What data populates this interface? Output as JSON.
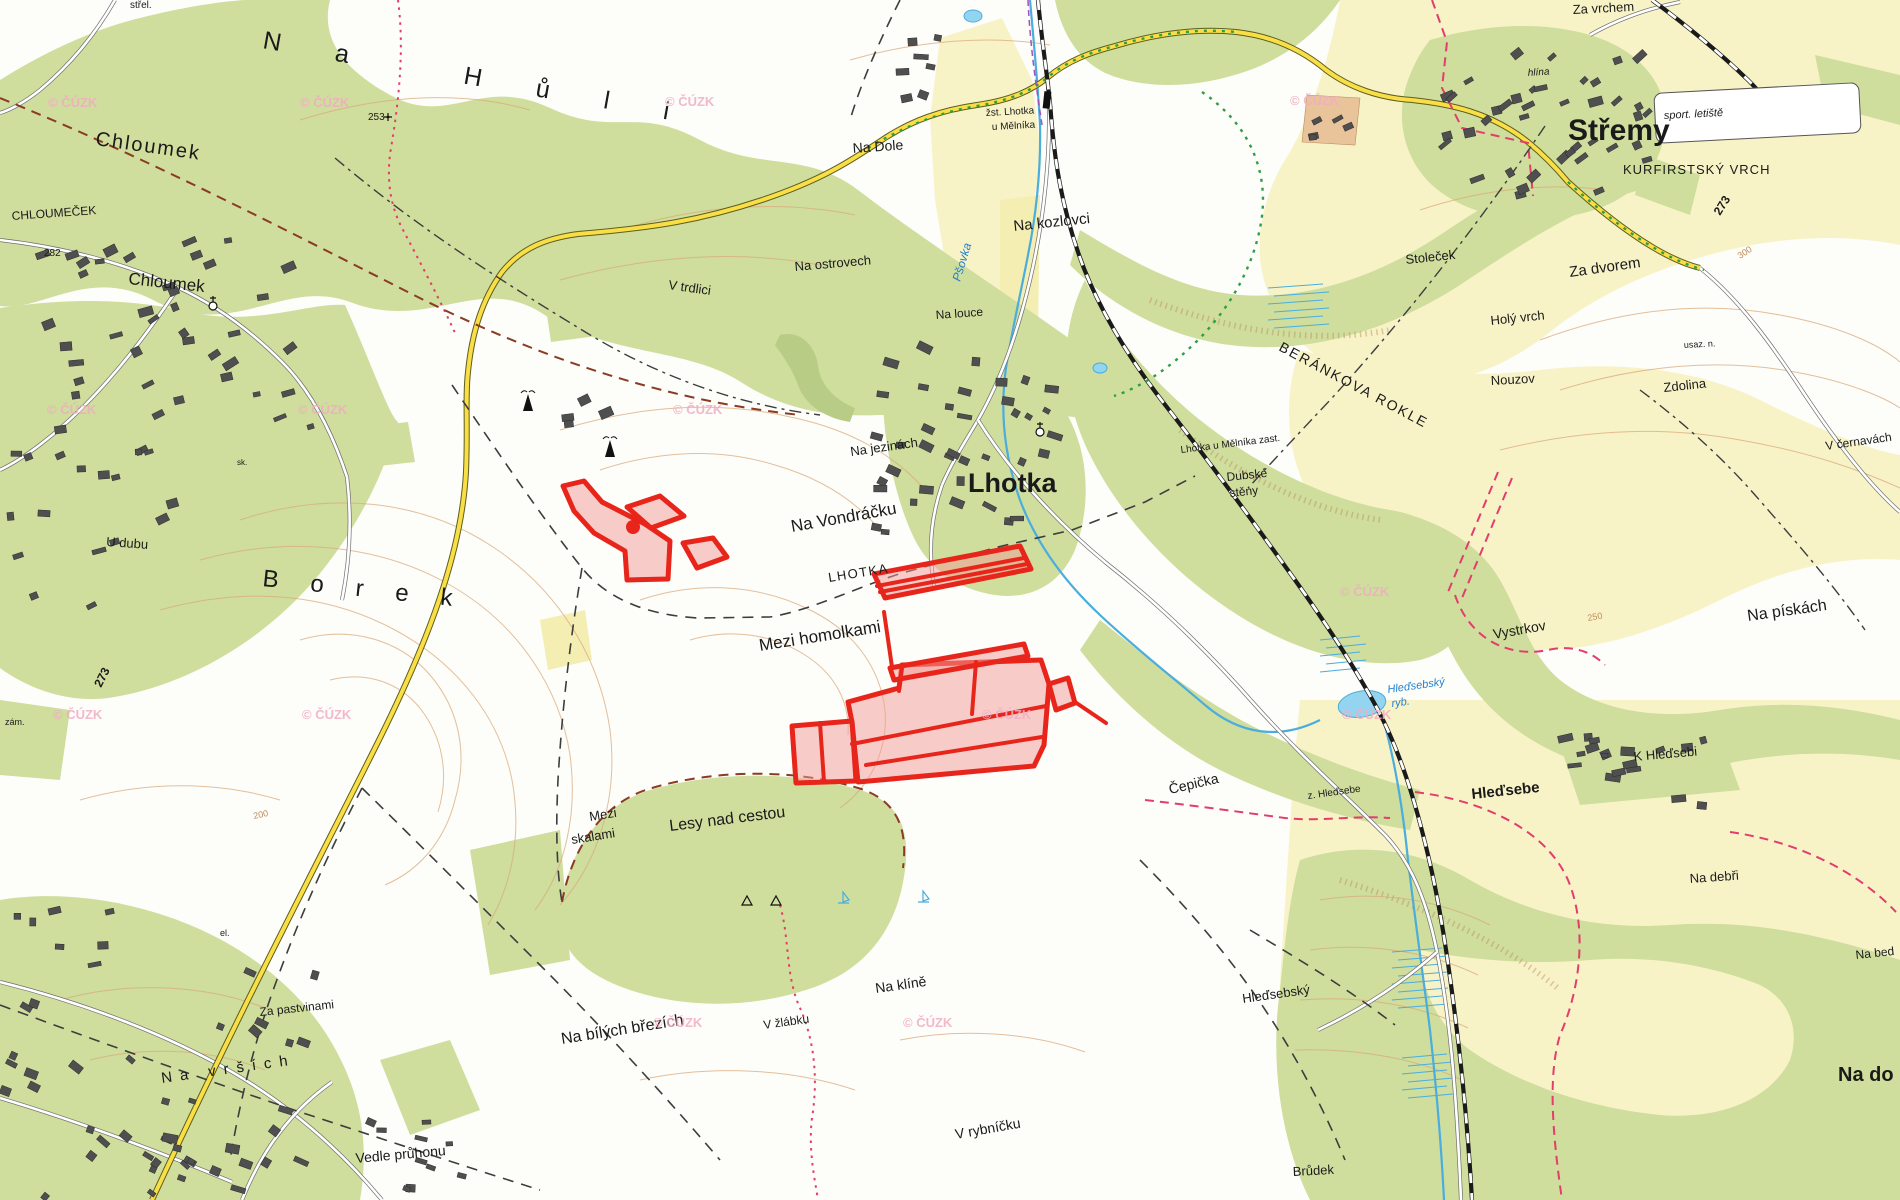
{
  "map": {
    "attribution": "© ČÚZK",
    "colors": {
      "forest": "#cfdd9d",
      "forest_dark": "#b9cc85",
      "field_yellow": "#f8f3c7",
      "orange_area": "#e9c49a",
      "water": "#4aadde",
      "water_fill": "#93d5f0",
      "contour": "#d9a97b",
      "road_yellow": "#f9df45",
      "railway": "#1a1a1a",
      "boundary_red": "#e23d6d",
      "boundary_darkred": "#8a3b24",
      "dash_black": "#3d3d3d",
      "trail_green": "#2f9e44",
      "parcel_stroke": "#e8251b",
      "parcel_fill": "#f29b95",
      "label": "#1a1a1a",
      "water_label": "#1f7fd0",
      "watermark": "#f0aec2",
      "building": "#4f4f4f"
    },
    "labels": [
      {
        "id": "strel",
        "t": "střel.",
        "x": 130,
        "y": 8,
        "s": 10,
        "r": 0
      },
      {
        "id": "na-huli",
        "t": "Na Hůli",
        "x": 262,
        "y": 48,
        "s": 25,
        "r": 10,
        "ls": 55
      },
      {
        "id": "chloumek-forest",
        "t": "Chloumek",
        "x": 95,
        "y": 145,
        "s": 20,
        "r": 8,
        "ls": 2
      },
      {
        "id": "chloumecek",
        "t": "CHLOUMEČEK",
        "x": 12,
        "y": 220,
        "s": 12,
        "r": -4
      },
      {
        "id": "h282",
        "t": "282",
        "x": 44,
        "y": 256,
        "s": 10,
        "r": 0
      },
      {
        "id": "chloumek-village",
        "t": "Chloumek",
        "x": 128,
        "y": 284,
        "s": 17,
        "r": 6
      },
      {
        "id": "h253",
        "t": "253",
        "x": 368,
        "y": 120,
        "s": 10,
        "r": 0
      },
      {
        "id": "na-dole",
        "t": "Na Dole",
        "x": 853,
        "y": 153,
        "s": 14,
        "r": -4
      },
      {
        "id": "zst-1",
        "t": "žst. Lhotka",
        "x": 986,
        "y": 116,
        "s": 10,
        "r": -3
      },
      {
        "id": "zst-2",
        "t": "u Mělníka",
        "x": 992,
        "y": 130,
        "s": 10,
        "r": -3
      },
      {
        "id": "na-kozlovci",
        "t": "Na kozlovci",
        "x": 1014,
        "y": 231,
        "s": 15,
        "r": -6
      },
      {
        "id": "na-ostrovech",
        "t": "Na ostrovech",
        "x": 795,
        "y": 271,
        "s": 13,
        "r": -5
      },
      {
        "id": "v-trdlici",
        "t": "V trdlici",
        "x": 668,
        "y": 289,
        "s": 13,
        "r": 8
      },
      {
        "id": "na-louce",
        "t": "Na louce",
        "x": 936,
        "y": 319,
        "s": 12,
        "r": -4
      },
      {
        "id": "psovka",
        "t": "Pšovka",
        "x": 960,
        "y": 282,
        "s": 12,
        "r": -73,
        "c": "water"
      },
      {
        "id": "stremy",
        "t": "Střemy",
        "x": 1568,
        "y": 140,
        "s": 30,
        "w": "bold"
      },
      {
        "id": "sport-letiste",
        "t": "sport. letiště",
        "x": 1664,
        "y": 119,
        "s": 11,
        "r": -3,
        "i": true
      },
      {
        "id": "kurfirstsky-vrch",
        "t": "KURFIRSTSKÝ VRCH",
        "x": 1623,
        "y": 174,
        "s": 13,
        "ls": 1
      },
      {
        "id": "r273-ne",
        "t": "273",
        "x": 1720,
        "y": 216,
        "s": 12,
        "r": -58,
        "w": "bold"
      },
      {
        "id": "c300",
        "t": "300",
        "x": 1740,
        "y": 259,
        "s": 9,
        "r": -33,
        "c": "contour"
      },
      {
        "id": "za-vrchem",
        "t": "Za vrchem",
        "x": 1573,
        "y": 14,
        "s": 13,
        "r": -3
      },
      {
        "id": "hlina",
        "t": "hlína",
        "x": 1528,
        "y": 76,
        "s": 10,
        "r": -4,
        "i": true
      },
      {
        "id": "stolecek",
        "t": "Stoleček",
        "x": 1406,
        "y": 264,
        "s": 13,
        "r": -6
      },
      {
        "id": "za-dvorem",
        "t": "Za dvorem",
        "x": 1570,
        "y": 277,
        "s": 15,
        "r": -8
      },
      {
        "id": "holy-vrch",
        "t": "Holý vrch",
        "x": 1491,
        "y": 325,
        "s": 13,
        "r": -6
      },
      {
        "id": "nouzov",
        "t": "Nouzov",
        "x": 1491,
        "y": 385,
        "s": 13,
        "r": -3
      },
      {
        "id": "zdolina",
        "t": "Zdolina",
        "x": 1664,
        "y": 392,
        "s": 13,
        "r": -6
      },
      {
        "id": "usaz-n",
        "t": "usaz. n.",
        "x": 1684,
        "y": 348,
        "s": 9,
        "r": -3
      },
      {
        "id": "v-cernavach",
        "t": "V černavách",
        "x": 1826,
        "y": 450,
        "s": 12,
        "r": -8
      },
      {
        "id": "berankova-rokle",
        "t": "BERÁNKOVA ROKLE",
        "x": 1278,
        "y": 350,
        "s": 14,
        "r": 28,
        "ls": 2
      },
      {
        "id": "lhotka-zast",
        "t": "Lhotka u Mělníka zast.",
        "x": 1181,
        "y": 453,
        "s": 10,
        "r": -7
      },
      {
        "id": "dubske",
        "t": "Dubské",
        "x": 1227,
        "y": 481,
        "s": 12,
        "r": -6
      },
      {
        "id": "steny",
        "t": "stěny",
        "x": 1230,
        "y": 497,
        "s": 12,
        "r": -6
      },
      {
        "id": "lhotka-big",
        "t": "Lhotka",
        "x": 968,
        "y": 492,
        "s": 27,
        "w": "bold"
      },
      {
        "id": "na-jezinach",
        "t": "Na jezinách",
        "x": 851,
        "y": 456,
        "s": 13,
        "r": -8
      },
      {
        "id": "na-vondracku",
        "t": "Na Vondráčku",
        "x": 792,
        "y": 532,
        "s": 17,
        "r": -10
      },
      {
        "id": "lhotka-caps",
        "t": "LHOTKA",
        "x": 829,
        "y": 582,
        "s": 13,
        "r": -9,
        "ls": 1.5
      },
      {
        "id": "mezi-homolkami",
        "t": "Mezi homolkami",
        "x": 760,
        "y": 651,
        "s": 17,
        "r": -9
      },
      {
        "id": "u-dubu",
        "t": "U dubu",
        "x": 106,
        "y": 546,
        "s": 13,
        "r": 4
      },
      {
        "id": "borek",
        "t": "Borek",
        "x": 262,
        "y": 586,
        "s": 24,
        "r": 6,
        "ls": 32
      },
      {
        "id": "r273-left",
        "t": "273",
        "x": 101,
        "y": 688,
        "s": 12,
        "r": -63,
        "w": "bold"
      },
      {
        "id": "zam",
        "t": "zám.",
        "x": 5,
        "y": 725,
        "s": 9
      },
      {
        "id": "sk",
        "t": "sk.",
        "x": 237,
        "y": 465,
        "s": 8
      },
      {
        "id": "el",
        "t": "el.",
        "x": 220,
        "y": 936,
        "s": 9
      },
      {
        "id": "c200",
        "t": "200",
        "x": 254,
        "y": 819,
        "s": 9,
        "r": -12,
        "c": "contour"
      },
      {
        "id": "c250",
        "t": "250",
        "x": 1588,
        "y": 621,
        "s": 9,
        "r": -10,
        "c": "contour"
      },
      {
        "id": "vystrkov",
        "t": "Vystrkov",
        "x": 1494,
        "y": 639,
        "s": 14,
        "r": -10
      },
      {
        "id": "na-piskach",
        "t": "Na pískách",
        "x": 1748,
        "y": 621,
        "s": 16,
        "r": -8
      },
      {
        "id": "hledsebsky-ryb-1",
        "t": "Hleďsebský",
        "x": 1388,
        "y": 693,
        "s": 11,
        "r": -8,
        "c": "water"
      },
      {
        "id": "hledsebsky-ryb-2",
        "t": "ryb.",
        "x": 1392,
        "y": 707,
        "s": 11,
        "r": -8,
        "c": "water"
      },
      {
        "id": "k-hledsebi",
        "t": "K Hleďsebi",
        "x": 1634,
        "y": 761,
        "s": 13,
        "r": -5
      },
      {
        "id": "hledsebe",
        "t": "Hleďsebe",
        "x": 1472,
        "y": 799,
        "s": 15,
        "r": -6,
        "w": "bold"
      },
      {
        "id": "z-hledsebe",
        "t": "z. Hleďsebe",
        "x": 1308,
        "y": 799,
        "s": 10,
        "r": -8
      },
      {
        "id": "cepicka",
        "t": "Čepička",
        "x": 1170,
        "y": 794,
        "s": 14,
        "r": -13
      },
      {
        "id": "na-debri",
        "t": "Na debři",
        "x": 1690,
        "y": 883,
        "s": 13,
        "r": -4
      },
      {
        "id": "na-bed",
        "t": "Na bed",
        "x": 1856,
        "y": 959,
        "s": 12,
        "r": -6
      },
      {
        "id": "lesy-nad-cestou",
        "t": "Lesy nad cestou",
        "x": 670,
        "y": 831,
        "s": 16,
        "r": -7
      },
      {
        "id": "mezi-skalami-1",
        "t": "Mezi",
        "x": 590,
        "y": 821,
        "s": 13,
        "r": -9
      },
      {
        "id": "mezi-skalami-2",
        "t": "skalami",
        "x": 572,
        "y": 844,
        "s": 13,
        "r": -9
      },
      {
        "id": "na-kline",
        "t": "Na klíně",
        "x": 876,
        "y": 993,
        "s": 14,
        "r": -8
      },
      {
        "id": "v-zlabku",
        "t": "V žlábku",
        "x": 764,
        "y": 1029,
        "s": 12,
        "r": -8
      },
      {
        "id": "na-bilych-brezich",
        "t": "Na bílých březích",
        "x": 562,
        "y": 1044,
        "s": 16,
        "r": -9
      },
      {
        "id": "v-rybnicku",
        "t": "V rybníčku",
        "x": 956,
        "y": 1139,
        "s": 14,
        "r": -10
      },
      {
        "id": "hledsebsky-area",
        "t": "Hleďsebský",
        "x": 1243,
        "y": 1003,
        "s": 13,
        "r": -8
      },
      {
        "id": "brudek",
        "t": "Brůdek",
        "x": 1293,
        "y": 1176,
        "s": 13,
        "r": -3
      },
      {
        "id": "na-do",
        "t": "Na do",
        "x": 1838,
        "y": 1081,
        "s": 20,
        "w": "bold"
      },
      {
        "id": "vedle-pruhonu",
        "t": "Vedle průhonu",
        "x": 356,
        "y": 1163,
        "s": 14,
        "r": -5
      },
      {
        "id": "na-vrsich",
        "t": "Na vrších",
        "x": 162,
        "y": 1083,
        "s": 15,
        "r": -8,
        "ls": 8
      },
      {
        "id": "za-pastvinami",
        "t": "Za pastvinami",
        "x": 260,
        "y": 1016,
        "s": 12,
        "r": -6
      }
    ],
    "watermark_positions": [
      [
        48,
        107
      ],
      [
        300,
        107
      ],
      [
        665,
        106
      ],
      [
        1290,
        105
      ],
      [
        47,
        414
      ],
      [
        298,
        414
      ],
      [
        673,
        414
      ],
      [
        1340,
        596
      ],
      [
        53,
        719
      ],
      [
        302,
        719
      ],
      [
        982,
        719
      ],
      [
        653,
        1027
      ],
      [
        903,
        1027
      ],
      [
        1342,
        719
      ]
    ],
    "highlight_parcels": {
      "polygons": [
        {
          "id": "borek-wedge",
          "pts": [
            [
              563,
              486
            ],
            [
              584,
              481
            ],
            [
              602,
              502
            ],
            [
              645,
              524
            ],
            [
              670,
              541
            ],
            [
              668,
              579
            ],
            [
              627,
              580
            ],
            [
              625,
              551
            ],
            [
              594,
              533
            ],
            [
              574,
              511
            ]
          ]
        },
        {
          "id": "borek-para",
          "pts": [
            [
              627,
              507
            ],
            [
              660,
              496
            ],
            [
              684,
              516
            ],
            [
              651,
              528
            ]
          ]
        },
        {
          "id": "borek-rhomb",
          "pts": [
            [
              683,
              543
            ],
            [
              713,
              538
            ],
            [
              727,
              557
            ],
            [
              697,
              568
            ]
          ]
        },
        {
          "id": "band-upper",
          "pts": [
            [
              874,
              574
            ],
            [
              1020,
              546
            ],
            [
              1031,
              569
            ],
            [
              885,
              598
            ]
          ]
        },
        {
          "id": "c-left-para",
          "pts": [
            [
              792,
              726
            ],
            [
              852,
              721
            ],
            [
              856,
              781
            ],
            [
              796,
              783
            ]
          ]
        },
        {
          "id": "c-main",
          "pts": [
            [
              848,
              702
            ],
            [
              899,
              688
            ],
            [
              902,
              665
            ],
            [
              1041,
              660
            ],
            [
              1049,
              684
            ],
            [
              1044,
              745
            ],
            [
              1034,
              766
            ],
            [
              858,
              782
            ],
            [
              852,
              722
            ]
          ]
        },
        {
          "id": "c-top-strip",
          "pts": [
            [
              890,
              668
            ],
            [
              1024,
              644
            ],
            [
              1028,
              656
            ],
            [
              894,
              680
            ]
          ]
        },
        {
          "id": "c-right-para",
          "pts": [
            [
              1049,
              684
            ],
            [
              1068,
              678
            ],
            [
              1075,
              703
            ],
            [
              1056,
              710
            ]
          ]
        }
      ],
      "lines": [
        {
          "id": "band-stripe-1",
          "pts": [
            [
              877,
              586
            ],
            [
              1024,
              558
            ]
          ]
        },
        {
          "id": "band-stripe-2",
          "pts": [
            [
              880,
              592
            ],
            [
              1027,
              564
            ]
          ]
        },
        {
          "id": "c-stripe-1",
          "pts": [
            [
              852,
              744
            ],
            [
              1046,
              706
            ]
          ]
        },
        {
          "id": "c-stripe-2",
          "pts": [
            [
              866,
              765
            ],
            [
              1042,
              737
            ]
          ]
        },
        {
          "id": "c-divider-v",
          "pts": [
            [
              976,
              662
            ],
            [
              972,
              714
            ]
          ]
        },
        {
          "id": "c-divider-s",
          "pts": [
            [
              902,
              667
            ],
            [
              899,
              691
            ]
          ]
        },
        {
          "id": "c-left-div",
          "pts": [
            [
              820,
              723
            ],
            [
              824,
              782
            ]
          ]
        },
        {
          "id": "connector-b-c",
          "pts": [
            [
              884,
              612
            ],
            [
              892,
              667
            ]
          ]
        },
        {
          "id": "spur-east",
          "pts": [
            [
              1075,
              702
            ],
            [
              1106,
              723
            ]
          ]
        }
      ],
      "dot": {
        "x": 633,
        "y": 527,
        "r": 7
      }
    },
    "symbols": [
      {
        "type": "antenna",
        "x": 528,
        "y": 402
      },
      {
        "type": "antenna",
        "x": 610,
        "y": 448
      },
      {
        "type": "church",
        "x": 213,
        "y": 306
      },
      {
        "type": "church",
        "x": 1040,
        "y": 432
      },
      {
        "type": "triangle",
        "x": 747,
        "y": 901
      },
      {
        "type": "triangle",
        "x": 776,
        "y": 901
      },
      {
        "type": "boat",
        "x": 843,
        "y": 899
      },
      {
        "type": "boat",
        "x": 923,
        "y": 898
      },
      {
        "type": "cross",
        "x": 388,
        "y": 117
      }
    ]
  }
}
